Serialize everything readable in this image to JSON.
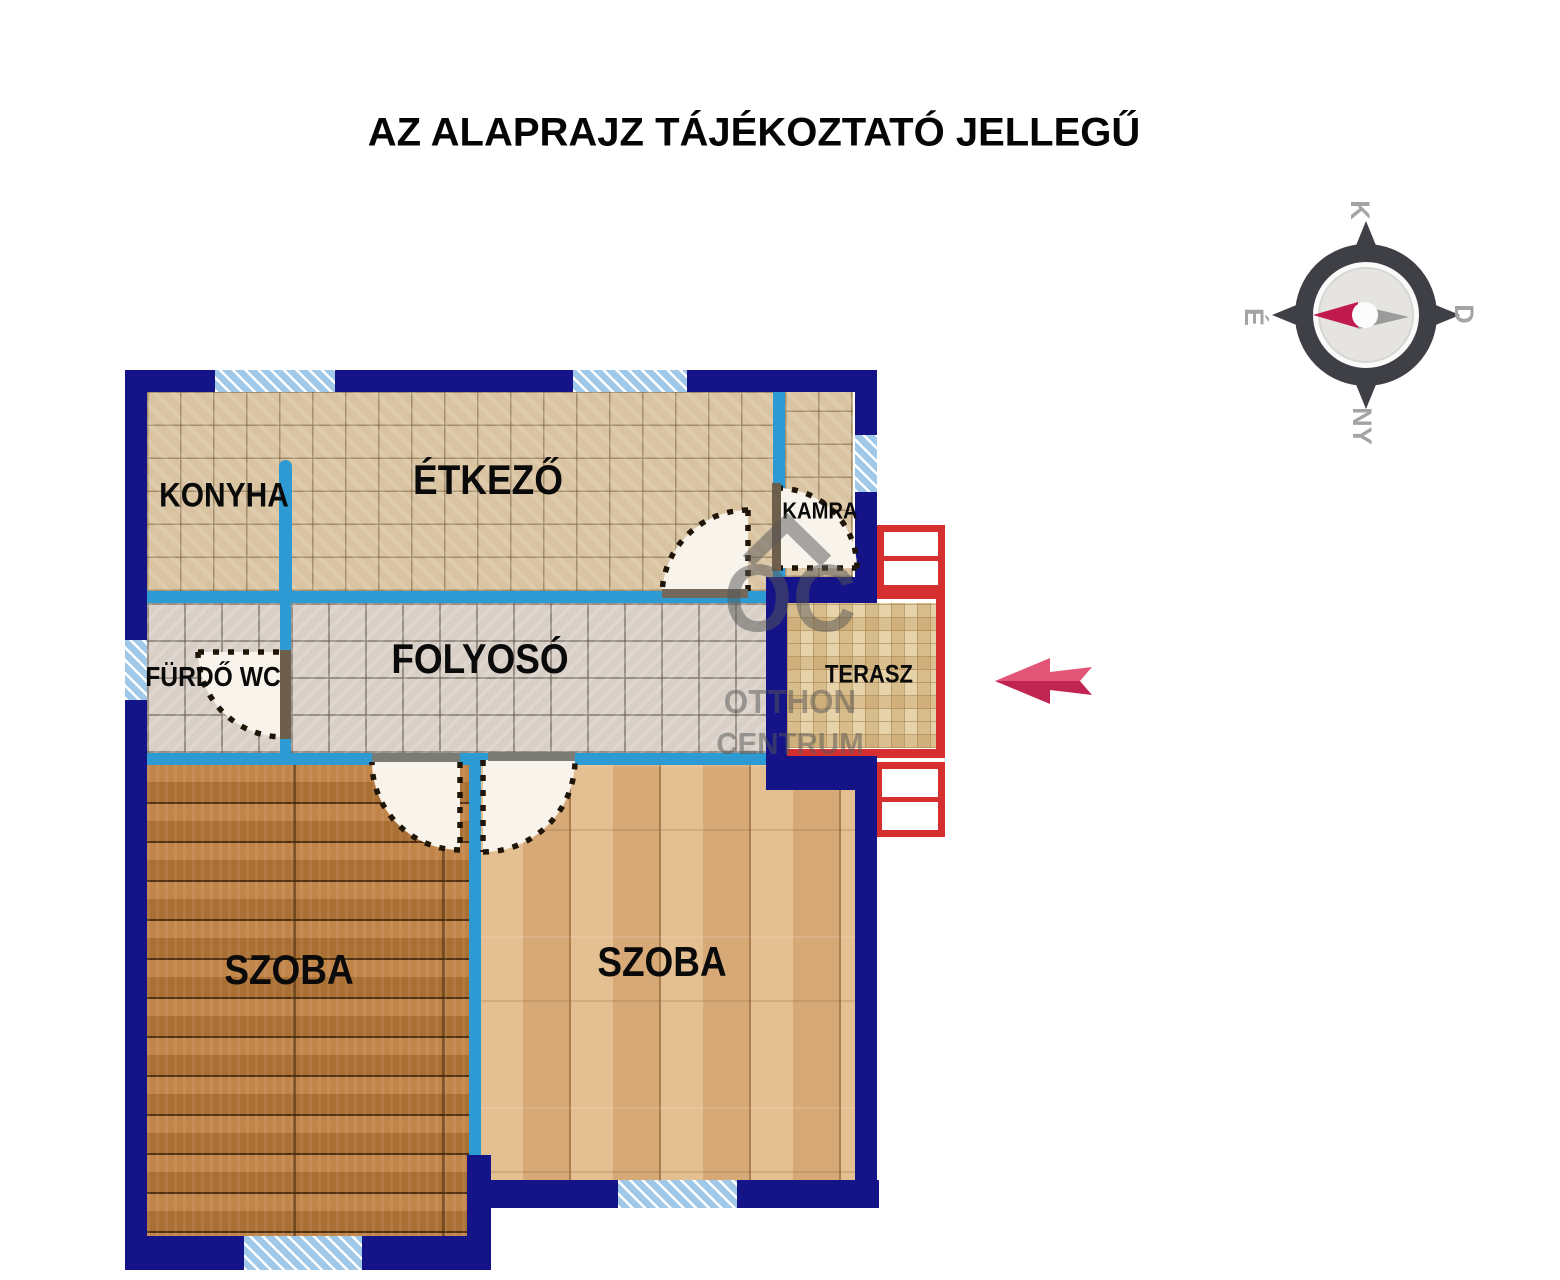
{
  "header": {
    "title": "AZ ALAPRAJZ TÁJÉKOZTATÓ JELLEGŰ"
  },
  "rooms": {
    "konyha": {
      "label": "KONYHA"
    },
    "etkezo": {
      "label": "ÉTKEZŐ"
    },
    "kamra": {
      "label": "KAMRA"
    },
    "furdo_wc": {
      "label": "FÜRDŐ WC"
    },
    "folyoso": {
      "label": "FOLYOSÓ"
    },
    "terasz": {
      "label": "TERASZ"
    },
    "szoba_left": {
      "label": "SZOBA"
    },
    "szoba_right": {
      "label": "SZOBA"
    }
  },
  "compass": {
    "top": "K",
    "right": "D",
    "bottom": "NY",
    "left": "É"
  },
  "watermark": {
    "logo": "OC",
    "line1": "OTTHON",
    "line2": "CENTRUM"
  },
  "colors": {
    "outer_wall": "#141488",
    "inner_wall": "#2d9ad3",
    "window_blue": "#a0c8e8",
    "terrace_red": "#d62f2f",
    "arrow_pink": "#e25576",
    "arrow_dark": "#c02451",
    "compass_needle_red": "#c11a4f",
    "compass_ring": "#3f3f46"
  }
}
